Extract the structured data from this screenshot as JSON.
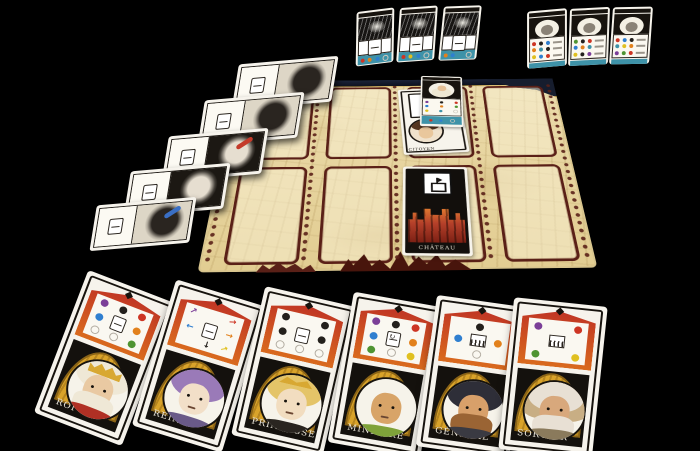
{
  "scene": {
    "background": "#000000",
    "description": "Tabletop photo of a French castle card game on a black surface"
  },
  "palette": {
    "purple": "#7b3f98",
    "black": "#23201c",
    "red": "#cd3524",
    "blue": "#2f7fd0",
    "orange": "#e2811c",
    "green": "#4f9432",
    "yellow": "#e0c020",
    "teal": "#3e92a8",
    "ring": "#b5b0a6",
    "slot_border": "#5a2017",
    "corner_navy": "#161d2e",
    "arch_gold": "#d9a32a",
    "parchment": "#e7d5a0",
    "card_white": "#f6f3ec",
    "ink": "#17130e",
    "shield_red": "#c03524",
    "shield_orange": "#d96a1e",
    "castle_red": "#b5402a",
    "band_teal": "#3e92a8"
  },
  "board": {
    "rows": 2,
    "cols": 4,
    "slot_count": 8,
    "occupied": [
      {
        "row": 1,
        "col": 3,
        "card": "citoyen"
      },
      {
        "row": 2,
        "col": 3,
        "card": "chateau"
      }
    ],
    "citoyen": {
      "label": "CITOYEN"
    },
    "chateau": {
      "label": "CHÂTEAU"
    }
  },
  "reference_card": {
    "figure": "king",
    "rows": [
      [
        "purple",
        "black",
        "red"
      ],
      [
        "blue",
        "orange",
        "green"
      ],
      [
        "yellow",
        "teal",
        "ring"
      ]
    ],
    "band_dots": [
      "red",
      "blue",
      "ring"
    ]
  },
  "objective_cards": [
    {
      "band_dots": [
        "red",
        "orange",
        "blue",
        "ring"
      ]
    },
    {
      "band_dots": [
        "red",
        "yellow",
        "blue",
        "ring"
      ]
    },
    {
      "band_dots": [
        "orange",
        "blue",
        "teal",
        "ring"
      ]
    }
  ],
  "score_cards": [
    {
      "rows": [
        [
          "red",
          "black",
          "blue"
        ],
        [
          "orange",
          "teal",
          "black"
        ],
        [
          "yellow",
          "blue",
          "red"
        ]
      ]
    },
    {
      "rows": [
        [
          "green",
          "black",
          "red"
        ],
        [
          "blue",
          "orange",
          "teal"
        ],
        [
          "yellow",
          "black",
          "purple"
        ]
      ]
    },
    {
      "rows": [
        [
          "red",
          "blue",
          "black"
        ],
        [
          "teal",
          "yellow",
          "orange"
        ],
        [
          "purple",
          "green",
          "red"
        ]
      ]
    }
  ],
  "side_cards": [
    {
      "dots": [
        "teal",
        "red",
        "yellow"
      ],
      "art": "light",
      "accent": ""
    },
    {
      "dots": [
        "red",
        "blue",
        "green",
        "yellow"
      ],
      "art": "light",
      "accent": ""
    },
    {
      "dots": [],
      "art": "dark",
      "accent": "#c43a2a"
    },
    {
      "dots": [],
      "art": "dark",
      "accent": ""
    },
    {
      "dots": [],
      "art": "light",
      "accent": "#3a6fc4"
    }
  ],
  "characters": [
    {
      "label": "ROI",
      "grid": [
        "dot:purple",
        "dot:black",
        "dot:red",
        "dot:blue",
        "card",
        "dot:orange",
        "ring",
        "ring",
        "dot:green"
      ],
      "portrait": {
        "skin": "#e9c9a2",
        "hair": "#efe8d6",
        "beard": "#efe8d6",
        "hat": "#d8a832",
        "hat_type": "crown",
        "collar": "#b03024"
      }
    },
    {
      "label": "REINE",
      "grid": [
        "arrow:purple:-45",
        "",
        "arrow:red:-15",
        "arrow:blue:180",
        "card",
        "arrow:orange:0",
        "",
        "arrow:black:90",
        "arrow:yellow:-30"
      ],
      "portrait": {
        "skin": "#f2dfc8",
        "hair": "#9a7ab8",
        "beard": "",
        "hat": "",
        "hat_type": "",
        "collar": "#6a5a88"
      }
    },
    {
      "label": "PRINCESSE",
      "grid": [
        "dot:black",
        "",
        "dot:black",
        "dot:black",
        "card",
        "dot:black",
        "ring",
        "ring",
        "ring"
      ],
      "portrait": {
        "skin": "#f2ddc0",
        "hair": "#e4c468",
        "beard": "",
        "hat": "#d8a832",
        "hat_type": "tiara",
        "collar": "#2a2520"
      }
    },
    {
      "label": "MINISTRE",
      "grid": [
        "dot:purple",
        "dot:black",
        "dot:red",
        "dot:blue",
        "cardcycle",
        "dot:orange",
        "dot:green",
        "ring",
        "dot:yellow"
      ],
      "portrait": {
        "skin": "#d8a468",
        "hair": "",
        "beard": "",
        "hat": "",
        "hat_type": "",
        "collar": "#7fa23a"
      }
    },
    {
      "label": "GÉNÉRAL",
      "grid": [
        "",
        "dot:black",
        "",
        "dot:blue",
        "fence",
        "dot:orange",
        "",
        "ring",
        ""
      ],
      "portrait": {
        "skin": "#d8a06a",
        "hair": "#2e2e38",
        "beard": "#9a6434",
        "hat": "",
        "hat_type": "",
        "collar": "#3a3a42"
      }
    },
    {
      "label": "SORCIER",
      "grid": [
        "dot:purple",
        "",
        "dot:red",
        "",
        "fence",
        "",
        "dot:green",
        "",
        "dot:yellow"
      ],
      "portrait": {
        "skin": "#d8a87c",
        "hair": "#e8e0d4",
        "beard": "#e8e0d4",
        "hat": "#c8ae84",
        "hat_type": "hood",
        "collar": "#8a7a5c"
      }
    }
  ]
}
